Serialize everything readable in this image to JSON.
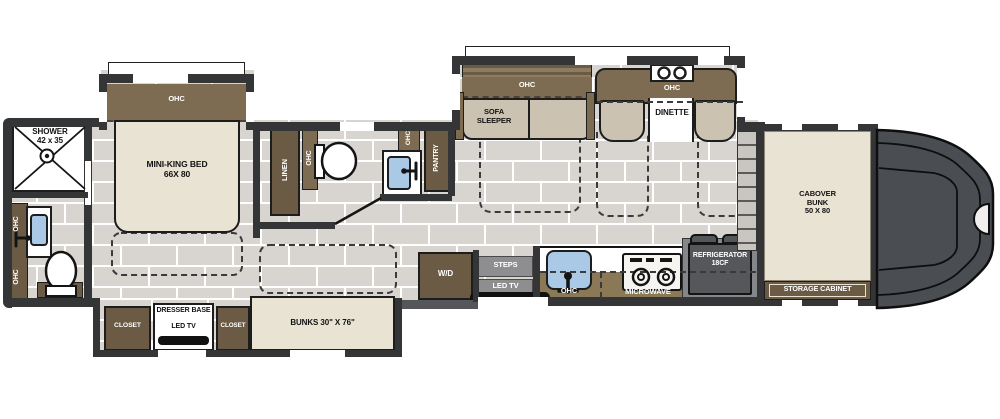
{
  "floorplan": {
    "labels": {
      "ohc": "OHC",
      "shower_l1": "SHOWER",
      "shower_l2": "42 x 35",
      "bed_l1": "MINI-KING BED",
      "bed_l2": "66X 80",
      "linen": "LINEN",
      "pantry": "PANTRY",
      "wd": "W/D",
      "steps": "STEPS",
      "led_tv": "LED TV",
      "closet": "CLOSET",
      "dresser_base": "DRESSER BASE",
      "bunks": "BUNKS 30\" X  76\"",
      "sofa_sleeper": "SOFA SLEEPER",
      "dinette": "DINETTE",
      "microwave": "MICROWAVE",
      "fridge_l1": "REFRIGERATOR",
      "fridge_l2": "18CF",
      "cabover_l1": "CABOVER",
      "cabover_l2": "BUNK",
      "cabover_l3": "50 X 80",
      "storage_cabinet": "STORAGE CABINET"
    },
    "colors": {
      "wall": "#333537",
      "floor_tile": "#d8d5d0",
      "cabinet_brown": "#6b5b44",
      "overhead_band": "#7d6c51",
      "counter_brown": "#8a7857",
      "upholstery_cream": "#e9e3d4",
      "upholstery_tan": "#cbc2b1",
      "sink_blue": "#a9c9e6",
      "appliance_gray": "#8e8e90",
      "refrigerator_gray": "#56575a",
      "truck_cab_gray": "#4a4e53"
    }
  }
}
